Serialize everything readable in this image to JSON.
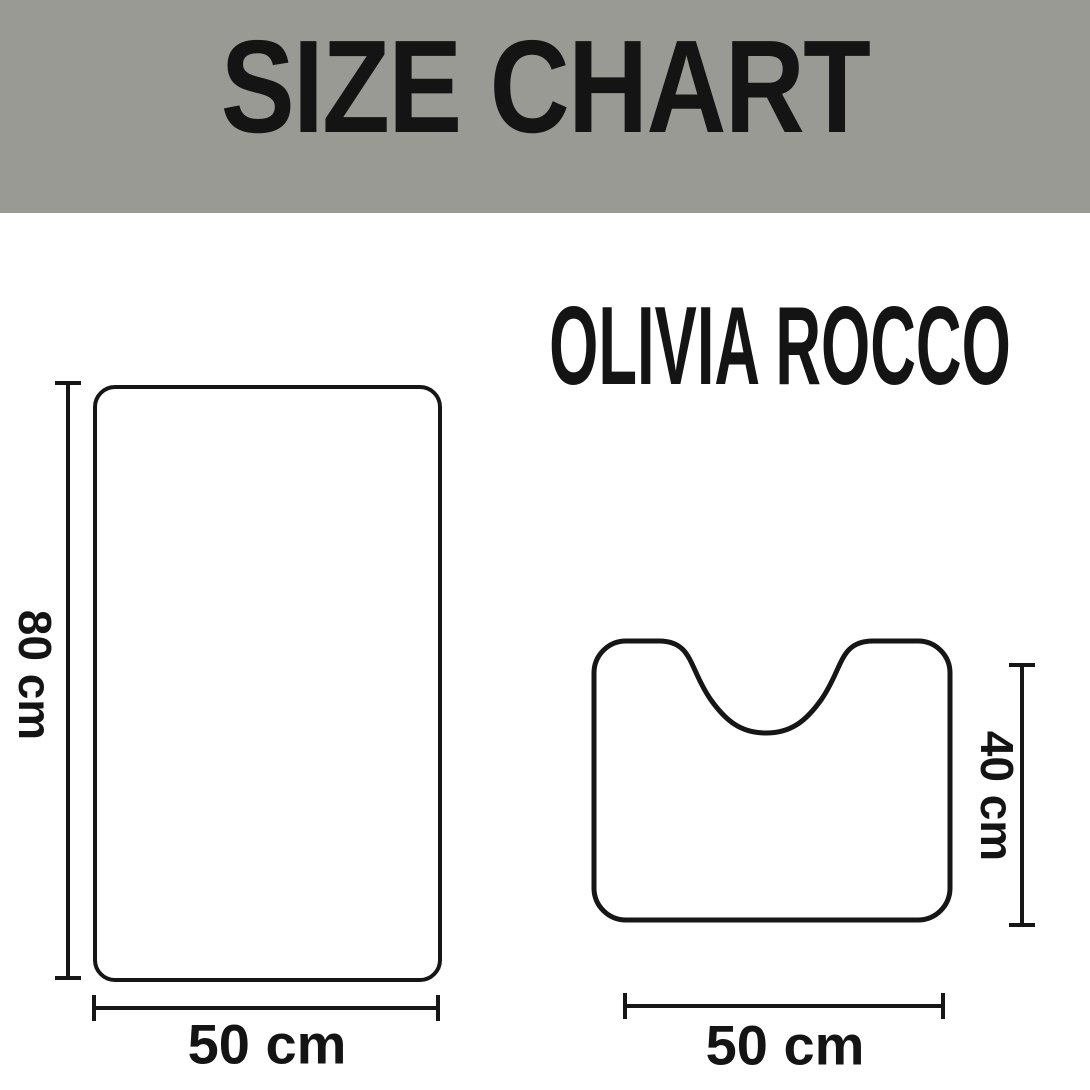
{
  "banner": {
    "title": "SIZE CHART",
    "background_color": "#9a9a95",
    "text_color": "#141414"
  },
  "brand": {
    "name": "OLIVIA ROCCO"
  },
  "diagram": {
    "ink_color": "#161616",
    "bath_mat": {
      "shape": "rounded rectangle",
      "height_label": "80 cm",
      "width_label": "50 cm"
    },
    "pedestal_mat": {
      "shape": "rounded square with U-shaped pedestal notch",
      "height_label": "40 cm",
      "width_label": "50 cm"
    }
  }
}
